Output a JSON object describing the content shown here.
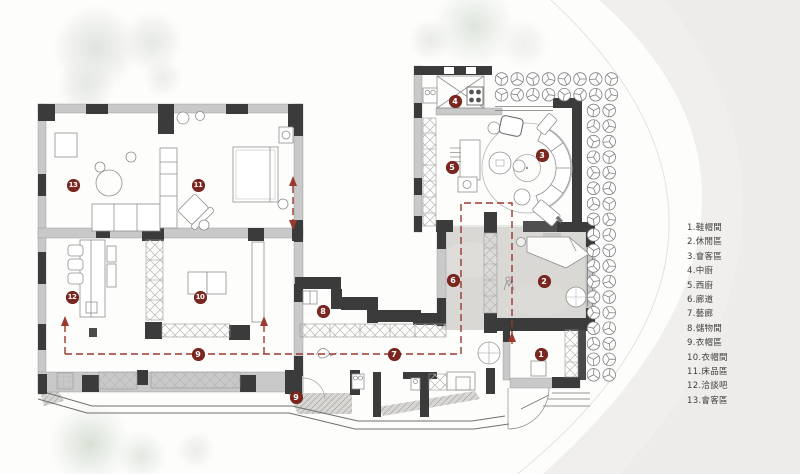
{
  "legend": {
    "items": [
      {
        "text": "1.鞋帽間"
      },
      {
        "text": "2.休閒區"
      },
      {
        "text": "3.會客區"
      },
      {
        "text": "4.中廚"
      },
      {
        "text": "5.西廚"
      },
      {
        "text": "6.廊道"
      },
      {
        "text": "7.藝廊"
      },
      {
        "text": "8.儲物間"
      },
      {
        "text": "9.衣帽區"
      },
      {
        "text": "10.衣帽間"
      },
      {
        "text": "11.床品區"
      },
      {
        "text": "12.洽談吧"
      },
      {
        "text": "13.會客區"
      }
    ]
  },
  "plan": {
    "marker_color": "#7b2720",
    "path_color": "#99392f",
    "markers": [
      {
        "text": "1",
        "x": 541,
        "y": 354
      },
      {
        "text": "2",
        "x": 544,
        "y": 281
      },
      {
        "text": "3",
        "x": 542,
        "y": 155
      },
      {
        "text": "4",
        "x": 455,
        "y": 101
      },
      {
        "text": "5",
        "x": 452,
        "y": 167
      },
      {
        "text": "6",
        "x": 453,
        "y": 280
      },
      {
        "text": "7",
        "x": 394,
        "y": 354
      },
      {
        "text": "8",
        "x": 323,
        "y": 311
      },
      {
        "text": "9",
        "x": 198,
        "y": 354
      },
      {
        "text": "9",
        "x": 296,
        "y": 397
      },
      {
        "text": "10",
        "x": 200,
        "y": 297
      },
      {
        "text": "11",
        "x": 198,
        "y": 185
      },
      {
        "text": "12",
        "x": 72,
        "y": 297
      },
      {
        "text": "13",
        "x": 73,
        "y": 185
      }
    ]
  }
}
